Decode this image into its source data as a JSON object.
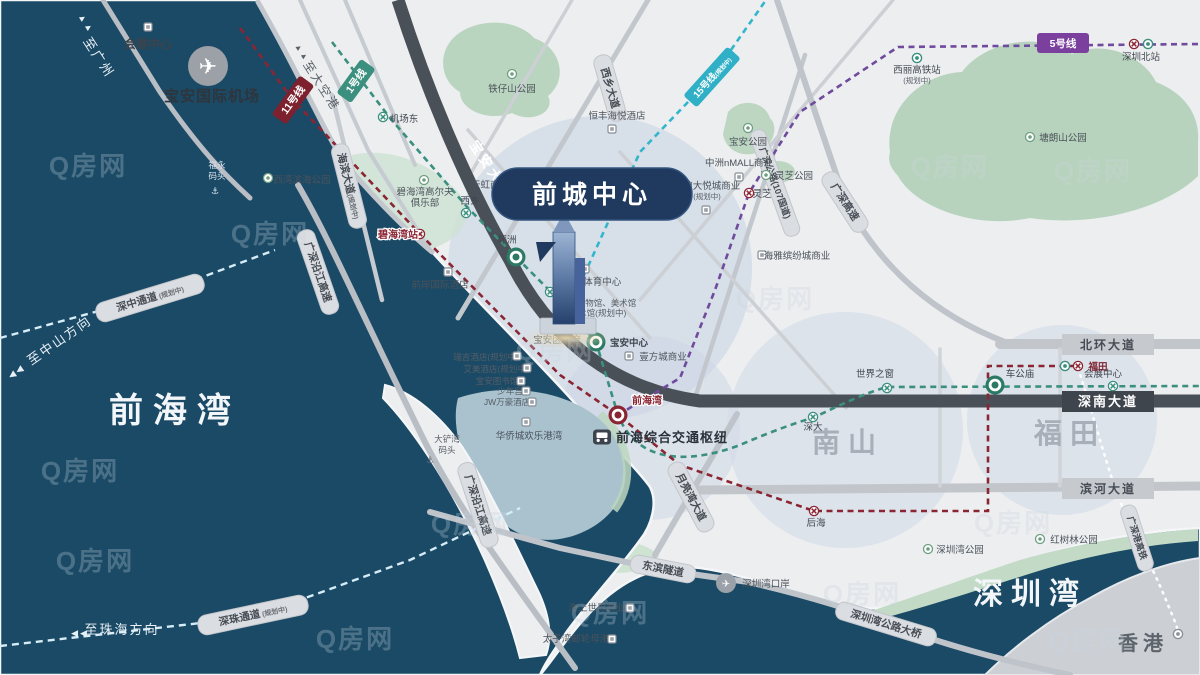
{
  "watermark": "Q房网",
  "landmark": {
    "title": "前城中心"
  },
  "areas": {
    "qianhai_bay": "前海湾",
    "shenzhen_bay": "深圳湾",
    "nanshan": "南山",
    "futian": "福田",
    "hongkong": "香港"
  },
  "directions": {
    "to_guangzhou": "至广州",
    "to_dakonggang": "至大空港",
    "to_zhongshan": "至中山方向",
    "to_zhuhai": "至珠海方向",
    "arrow_up": "▲▲",
    "arrow_left": "◀◀"
  },
  "metro": {
    "line1": "1号线",
    "line5": "5号线",
    "line11": "11号线",
    "line15": "15号线",
    "planned": "(规划中)"
  },
  "roads": {
    "baoan_avenue": "宝安大道",
    "shennan_avenue": "深南大道",
    "beihuan_avenue": "北环大道",
    "binhe_avenue": "滨河大道",
    "xixiang_avenue": "西乡大道",
    "gs_expressway": "广深高速",
    "gs_yanjiang_expressway": "广深沿江高速",
    "gs_highway_107": "广深公路(107国道)",
    "haibin_avenue": "海滨大道",
    "yueliangwan_avenue": "月亮湾大道",
    "dongbin_tunnel": "东滨隧道",
    "szw_bridge": "深圳湾公路大桥",
    "szhk_hsr": "广深港高铁",
    "shenzhong_corridor": "深中通道",
    "shenzhu_corridor": "深珠通道",
    "planned": "(规划中)"
  },
  "stations": {
    "jichangdong": "机场东",
    "xixiang": "西乡",
    "pingzhou": "坪洲",
    "baoti": "宝体",
    "baoan_center": "宝安中心",
    "bihaiwan": "碧海湾站",
    "lingzhi": "灵芝",
    "qianhaiwan": "前海湾",
    "qianhai_hub": "前海综合交通枢纽",
    "houhai": "后海",
    "shenda": "深大",
    "window_of_world": "世界之窗",
    "chegongmiao": "车公庙",
    "convention_station": "会展中心",
    "futian": "福田",
    "shenzhen_north": "深圳北站",
    "xili_hsr": "西丽高铁站",
    "planned": "(规划中)"
  },
  "pois": {
    "convention_center": "会展中心",
    "baoan_airport": "宝安国际机场",
    "fuyong_l1": "福永",
    "fuyong_l2": "码头",
    "xiwan_park": "西湾滨海公园",
    "tiezishan_park": "铁仔山公园",
    "bihaiwan_golf_l1": "碧海湾高尔夫",
    "bihaiwan_golf_l2": "俱乐部",
    "tianhong": "天虹商业",
    "qianan_hotel": "前岸国际酒店",
    "hengfeng_hotel": "恒丰海悦酒店",
    "baoan_park": "宝安公园",
    "zhongzhou_mall": "中洲nMALL商业",
    "zhongliang_l1": "中粮大悦城商业",
    "zhongliang_l2": "(规划中)",
    "lingzhi_park": "灵芝公园",
    "tanglangshan_park": "塘朗山公园",
    "haiya": "海雅缤纷城商业",
    "baoan_sports": "宝安区体育中心",
    "baoan_museum_l1": "宝安博物馆、美术馆",
    "baoan_museum_l2": "艺术馆(规划中)",
    "baoan_gov": "宝安区政府",
    "yifangcheng": "壹方城商业",
    "ruiji_hotel": "瑞吉酒店(规划中)",
    "aimei_hotel": "艾美酒店(规划中)",
    "baoan_library": "宝安图书馆",
    "shaoniangong": "少年宫",
    "jw_marriott": "JW万豪酒店",
    "oct_harbor": "华侨城欢乐港湾",
    "dachanwan_l1": "大铲湾",
    "dachanwan_l2": "码头",
    "world_window_area": "世界之窗",
    "sea_world": "海上世界商业",
    "prince_bay": "太子湾邮轮母港",
    "szw_port": "深圳湾口岸",
    "szw_park": "深圳湾公园",
    "mangrove_park": "红树林公园"
  },
  "colors": {
    "water": "#1b4a66",
    "land": "#eceef0",
    "line1": "#3a8f7e",
    "line5": "#6f4a9d",
    "line11": "#8a2533",
    "line15": "#33b5cb",
    "dark_road": "#4a5058",
    "landmark_badge": "#1f3a5e"
  }
}
